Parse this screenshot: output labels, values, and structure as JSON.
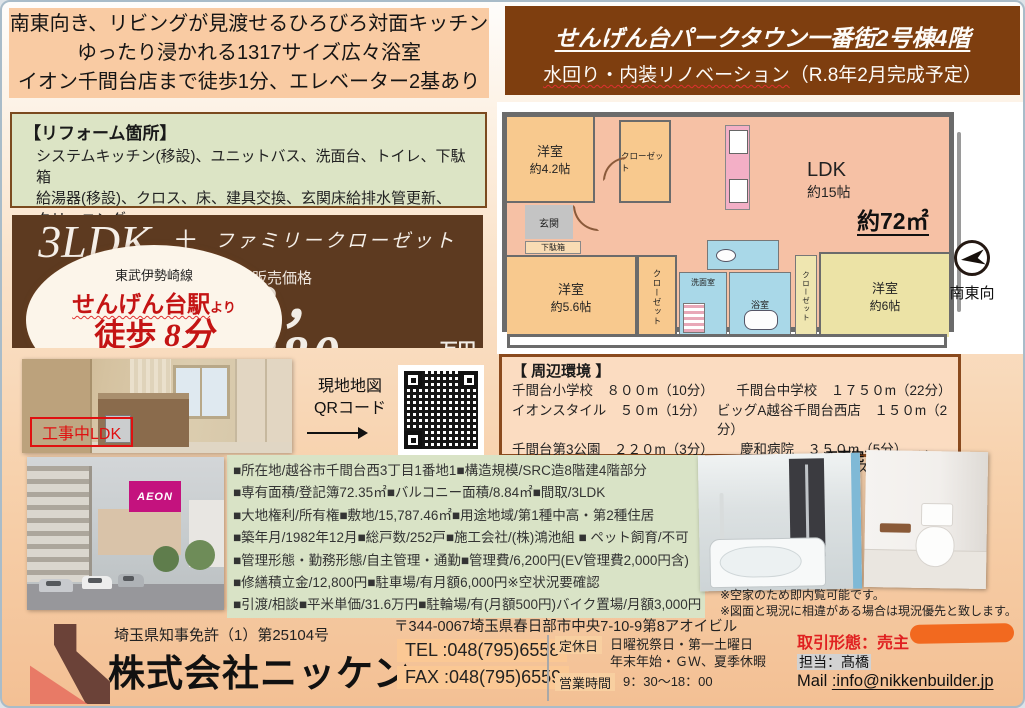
{
  "headline": {
    "lines": [
      "南東向き、リビングが見渡せるひろびろ対面キッチン",
      "ゆったり浸かれる1317サイズ広々浴室",
      "イオン千間台店まで徒歩1分、エレベーター2基あり"
    ]
  },
  "title_box": {
    "building": "せんげん台パークタウン一番街2号棟4階",
    "subtitle_main": "水回り・内装リノベーション",
    "subtitle_rest": "（R.8年2月完成予定）"
  },
  "reform": {
    "title": "【リフォーム箇所】",
    "lines": [
      "システムキッチン(移設)、ユニットバス、洗面台、トイレ、下駄箱",
      "給湯器(移設)、クロス、床、建具交換、玄関床給排水管更新、",
      "クリーニング"
    ]
  },
  "offer": {
    "layout": "3LDK",
    "plus": "＋",
    "layout_extra": "ファミリークローゼット",
    "price_label": "販売価格",
    "price": "2，280",
    "price_unit": "万円",
    "price_tax": "（税込）",
    "line_name": "東武伊勢崎線",
    "station": "せんげん台駅",
    "station_suffix": "より",
    "walk_prefix": "徒歩",
    "walk_value": "8分"
  },
  "floorplan": {
    "room1_name": "洋室",
    "room1_size": "約4.2帖",
    "closet1": "クローゼット",
    "genkan": "玄関",
    "shoe_box": "下駄箱",
    "ldk_name": "LDK",
    "ldk_size": "約15帖",
    "total_area": "約72㎡",
    "room2_name": "洋室",
    "room2_size": "約5.6帖",
    "closet2": "クローゼット",
    "washroom": "洗面室",
    "bath": "浴室",
    "closet3": "クローゼット",
    "room3_name": "洋室",
    "room3_size": "約6帖",
    "direction": "南東向"
  },
  "surroundings": {
    "title": "【 周辺環境 】",
    "rows": [
      [
        "千間台小学校　８００m（10分）",
        "千間台中学校　１７５０m（22分）"
      ],
      [
        "イオンスタイル　５０m（1分）",
        "ビッグA越谷千間台西店　１５０m（2分）"
      ],
      [
        "千間台第3公園　２２０m（3分）",
        "慶和病院　３５０m（5分）"
      ],
      [
        "セキチュー　３５０m（5分）",
        "ドラッグストアコスモス２５０m（4分）"
      ]
    ]
  },
  "ldk_photo": {
    "label": "工事中LDK"
  },
  "map_qr": {
    "label_line1": "現地地図",
    "label_line2": "QRコード"
  },
  "building_photo": {
    "sign": "AEON"
  },
  "details": {
    "lines": [
      "■所在地/越谷市千間台西3丁目1番地1■構造規模/SRC造8階建4階部分",
      "■専有面積/登記簿72.35㎡■バルコニー面積/8.84㎡■間取/3LDK",
      "■大地権利/所有権■敷地/15,787.46㎡■用途地域/第1種中高・第2種住居",
      "■築年月/1982年12月■総戸数/252戸■施工会社/(株)鴻池組 ■ ペット飼育/不可",
      "■管理形態・勤務形態/自主管理・通勤■管理費/6,200円(EV管理費2,000円含)",
      "■修繕積立金/12,800円■駐車場/有月額6,000円※空状況要確認",
      "■引渡/相談■平米単価/31.6万円■駐輪場/有(月額500円)バイク置場/月額3,000円"
    ]
  },
  "completion": {
    "label": "工事完了イメージ"
  },
  "notes": [
    "※空家のため即内覧可能です。",
    "※図面と現況に相違がある場合は現況優先と致します。"
  ],
  "footer": {
    "license": "埼玉県知事免許（1）第25104号",
    "company": "株式会社ニッケン",
    "address": "〒344-0067埼玉県春日部市中央7-10-9第8アオイビル",
    "tel": "TEL :048(795)6558",
    "fax": "FAX :048(795)6559",
    "holiday_label": "定休日",
    "holiday_line1": "日曜祝祭日・第一土曜日",
    "holiday_line2": "年末年始・ＧＷ、夏季休暇",
    "hours_label": "営業時間",
    "hours": "9：30～18：00",
    "deal_type": "取引形態：売主",
    "agent": "担当：髙橋",
    "mail_label": "Mail ",
    "mail_address": ":info@nikkenbuilder.jp"
  },
  "colors": {
    "brand_brown": "#5D3A20",
    "title_brown": "#7E3E0F",
    "headline_peach": "#F9CBA3",
    "reform_green": "#DCE4C5",
    "details_green": "#D9E3C6",
    "surroundings_peach": "#FBDCC1",
    "accent_red": "#CC1414",
    "pill_orange": "#F2691F",
    "aeon_magenta": "#C4127E"
  }
}
